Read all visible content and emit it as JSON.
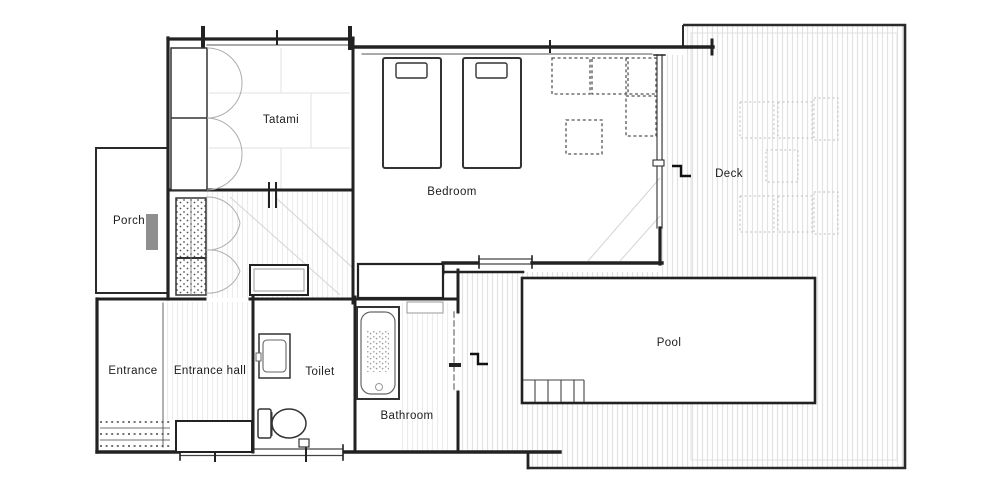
{
  "plan": {
    "type": "floor-plan",
    "rooms": {
      "tatami": "Tatami",
      "bedroom": "Bedroom",
      "deck": "Deck",
      "porch": "Porch",
      "pool": "Pool",
      "entrance": "Entrance",
      "entrance_hall": "Entrance hall",
      "toilet": "Toilet",
      "bathroom": "Bathroom"
    },
    "fixtures": [
      "single-bed",
      "single-bed",
      "sofa-set-dashed",
      "low-table-dashed",
      "deck-table-set",
      "deck-table-set",
      "deck-table",
      "bathtub",
      "washbasin",
      "toilet-bowl",
      "pool-steps",
      "step-marker-deck",
      "step-marker-pool",
      "closet-doors",
      "shoe-cabinet",
      "porch-mat",
      "genkan-step-tiles",
      "window-top",
      "window-side",
      "window-bottom"
    ],
    "colors": {
      "wall": "#222222",
      "line_medium": "#555555",
      "line_faint": "#bbbbbb",
      "deck_stripe": "#e3e3e3",
      "floor_stripe": "#ececec",
      "label": "#1c1c1c",
      "mat_gray": "#8f8f8f",
      "background": "#ffffff"
    }
  }
}
